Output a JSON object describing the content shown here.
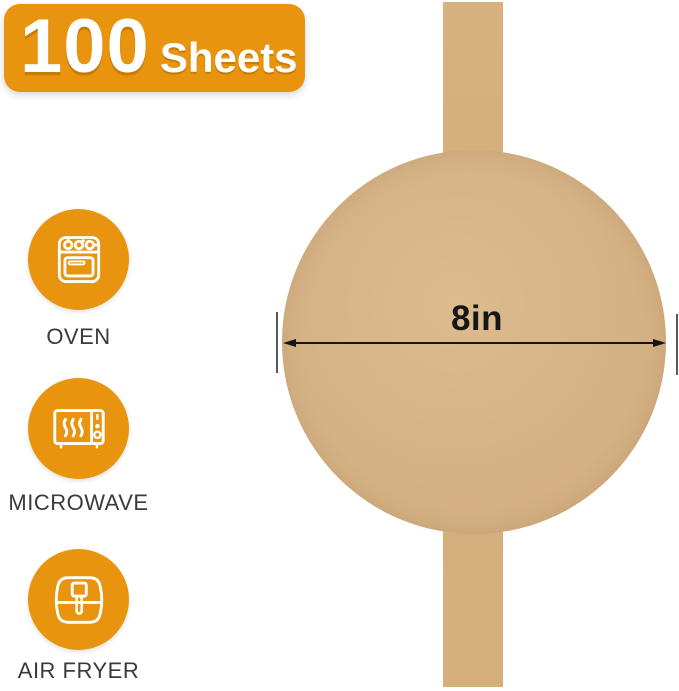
{
  "badge": {
    "count": "100",
    "unit": "Sheets"
  },
  "features": [
    {
      "icon": "oven-icon",
      "label": "OVEN"
    },
    {
      "icon": "microwave-icon",
      "label": "MICROWAVE"
    },
    {
      "icon": "air-fryer-icon",
      "label": "AIR FRYER"
    }
  ],
  "diagram": {
    "diameter_label": "8in"
  },
  "colors": {
    "accent_orange": "#e8940f",
    "kraft_round": "#d5b286",
    "kraft_strip": "#d5b07c",
    "dimension_line": "#151515",
    "extension_line": "#5a5a5a",
    "label_text": "#3a3a3a",
    "badge_text": "#ffffff"
  }
}
